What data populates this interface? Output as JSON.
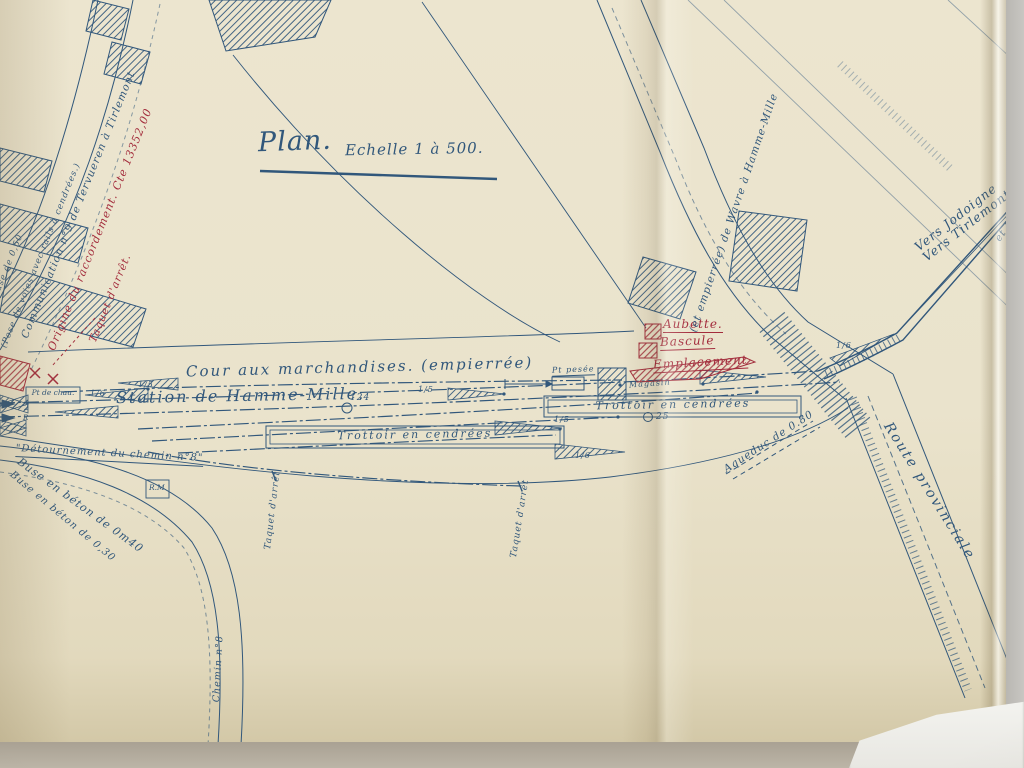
{
  "photo": {
    "description": "Photograph of a hand-drawn railway station plan on aged folded paper",
    "paper_color": "#e9e2cb",
    "ink_blue": "#31577b",
    "ink_red": "#a32c3c"
  },
  "title": {
    "main": "Plan.",
    "scale": "Echelle 1 à 500."
  },
  "labels": {
    "cour": "Cour aux marchandises. (empierrée)",
    "station": "Station de Hamme-Mille.",
    "trottoir_1": "Trottoir en cendrées",
    "trottoir_2": "Trottoir en cendrées",
    "aubette": "Aubette.",
    "bascule": "Bascule",
    "emplacement": "Emplacement",
    "magasin": "Magasin",
    "pt_pesee": "Pt pesée",
    "vers_jodoigne": "Vers Jodoigne",
    "vers_tirlemont": "Vers Tirlemont",
    "route_provinciale": "Route provinciale",
    "grand_route": "(et empierrée) de Wavre à Hamme-Mille",
    "communication": "Communication n°9 de Tervueren à Tirlemont",
    "origine": "Origine du raccordement. Cte 13352,00",
    "taquet_left": "Taquet d'arrêt.",
    "taquet_1": "Taquet d'arrêt",
    "taquet_2": "Taquet d'arrêt",
    "pose_note": "(Pose de voies avec rails à cendrées.)",
    "buse_fragment": "(Buse de 0,50",
    "detournement": "\"Détournement du chemin n°8\"",
    "buse_1": "Buse en béton de 0m40",
    "buse_2": "Buse en béton de 0,30",
    "rm": "R.M",
    "chemin_8": "Chemin n°8",
    "aqueduc": "Aqueduc de 0.80",
    "pt_chaux": "Pt de chau.",
    "longitudinal": "et Longitudinal",
    "marks": {
      "m124": "124",
      "m25": "25",
      "m2": "2",
      "mr": "R"
    },
    "turnouts": [
      "1/6",
      "1/5",
      "1/5",
      "1/5",
      "1/6",
      "1/6"
    ]
  }
}
